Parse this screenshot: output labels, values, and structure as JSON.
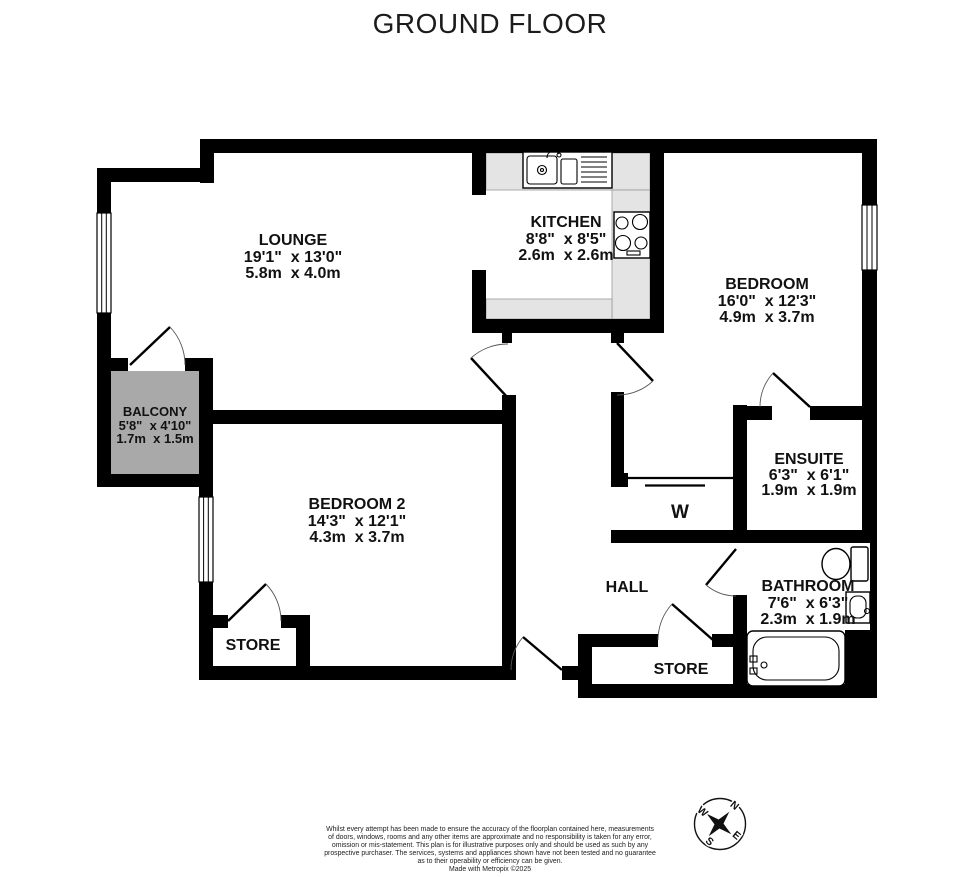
{
  "title": "GROUND FLOOR",
  "rooms": {
    "lounge": {
      "name": "LOUNGE",
      "imperial": "19'1\"  x 13'0\"",
      "metric": "5.8m  x 4.0m"
    },
    "kitchen": {
      "name": "KITCHEN",
      "imperial": "8'8\"  x 8'5\"",
      "metric": "2.6m  x 2.6m"
    },
    "bedroom": {
      "name": "BEDROOM",
      "imperial": "16'0\"  x 12'3\"",
      "metric": "4.9m  x 3.7m"
    },
    "balcony": {
      "name": "BALCONY",
      "imperial": "5'8\"  x 4'10\"",
      "metric": "1.7m  x 1.5m"
    },
    "bedroom2": {
      "name": "BEDROOM 2",
      "imperial": "14'3\"  x 12'1\"",
      "metric": "4.3m  x 3.7m"
    },
    "ensuite": {
      "name": "ENSUITE",
      "imperial": "6'3\"  x 6'1\"",
      "metric": "1.9m  x 1.9m"
    },
    "bathroom": {
      "name": "BATHROOM",
      "imperial": "7'6\"  x 6'3\"",
      "metric": "2.3m  x 1.9m"
    },
    "hall": {
      "name": "HALL"
    },
    "wardrobe": {
      "name": "W"
    },
    "store_left": {
      "name": "STORE"
    },
    "store_right": {
      "name": "STORE"
    }
  },
  "compass": {
    "n": "N",
    "e": "E",
    "s": "S",
    "w": "W"
  },
  "footer": {
    "lines": [
      "Whilst every attempt has been made to ensure the accuracy of the floorplan contained here, measurements",
      "of doors, windows, rooms and any other items are approximate and no responsibility is taken for any error,",
      "omission or mis-statement. This plan is for illustrative purposes only and should be used as such by any",
      "prospective purchaser. The services, systems and appliances shown have not been tested and no guarantee",
      "as to their operability or efficiency can be given."
    ],
    "credit": "Made with Metropix ©2025"
  },
  "colors": {
    "wall": "#000000",
    "balcony_fill": "#a9a9a9",
    "counter_fill": "#e4e4e4"
  }
}
